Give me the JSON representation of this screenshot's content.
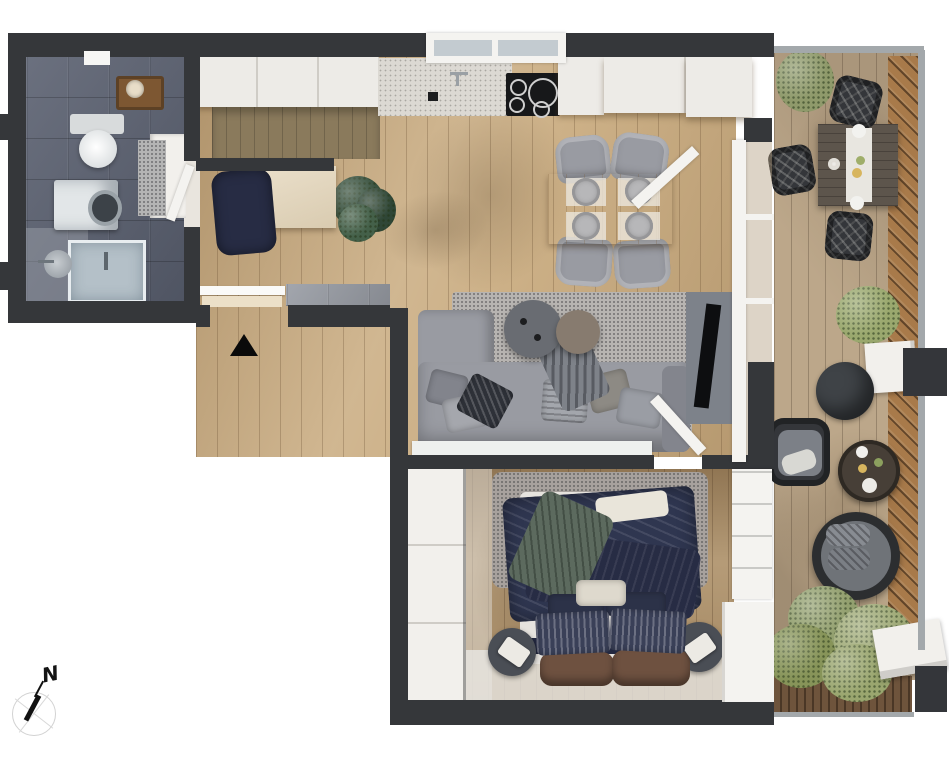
{
  "compass": {
    "label": "N"
  },
  "entrance": {
    "marker": "triangle-up"
  },
  "palette": {
    "wall": "#35373a",
    "woodMain": "#c9ab7f",
    "woodBed": "#ad9068",
    "tileBath": "#5a6070",
    "tileEntry": "#989ca4",
    "deckMain": "#bca78a",
    "deckDiag": "#a87a4a",
    "deckStrip": "#6e543c",
    "rail": "#a3a8ab",
    "cabinet": "#edebe7",
    "counterWood": "#8a7a5c",
    "stone": "#dcd9d3",
    "cooktop": "#17181a",
    "sofa": "#999ba2",
    "sofaDark": "#83858d",
    "rug": "#b7b4b1",
    "rugBed": "#a7a19d",
    "navy": "#2f3650",
    "navyDark": "#272c44",
    "greenThrow": "#5c6a5e",
    "plant": "#3b5643",
    "bush": "#99a371",
    "brownBench": "#6e5140",
    "dark": "#34363a",
    "white": "#f2f0ec",
    "glass": "#c3cbd0",
    "tv": "#0d0e10",
    "shelfWood": "#7d5732",
    "washer": "#e2e6e8",
    "shower": "#b4c0c8",
    "console": "#eef0ee",
    "mat": "#ece0c8",
    "nightstand": "#4a4e55",
    "pouf": "#3f4347",
    "terraceTable": "#5d554c"
  },
  "rooms": {
    "bathroom": {
      "items": [
        "wood-shelf",
        "toilet",
        "washing-machine",
        "shower",
        "hand-basin",
        "vanity",
        "bath-mat"
      ]
    },
    "entry": {
      "items": [
        "front-door",
        "door-mat"
      ]
    },
    "kitchen": {
      "items": [
        "upper-cabinets",
        "wood-counter",
        "stone-counter",
        "sink",
        "cooktop",
        "dining-table",
        "dining-chairs-4",
        "desk",
        "desk-chair",
        "monstera-plant"
      ]
    },
    "living": {
      "items": [
        "corner-sofa",
        "rug",
        "round-coffee-tables-2",
        "tv",
        "white-console"
      ]
    },
    "bedroom": {
      "items": [
        "wardrobe",
        "double-bed",
        "nightstands-2",
        "leather-bench",
        "rug"
      ]
    },
    "balcony": {
      "items": [
        "outdoor-dining-table",
        "wicker-chairs-3",
        "bushes",
        "pouf",
        "lounge-chair",
        "round-table",
        "hanging-chair",
        "tree-group",
        "white-bench",
        "planter"
      ]
    }
  }
}
